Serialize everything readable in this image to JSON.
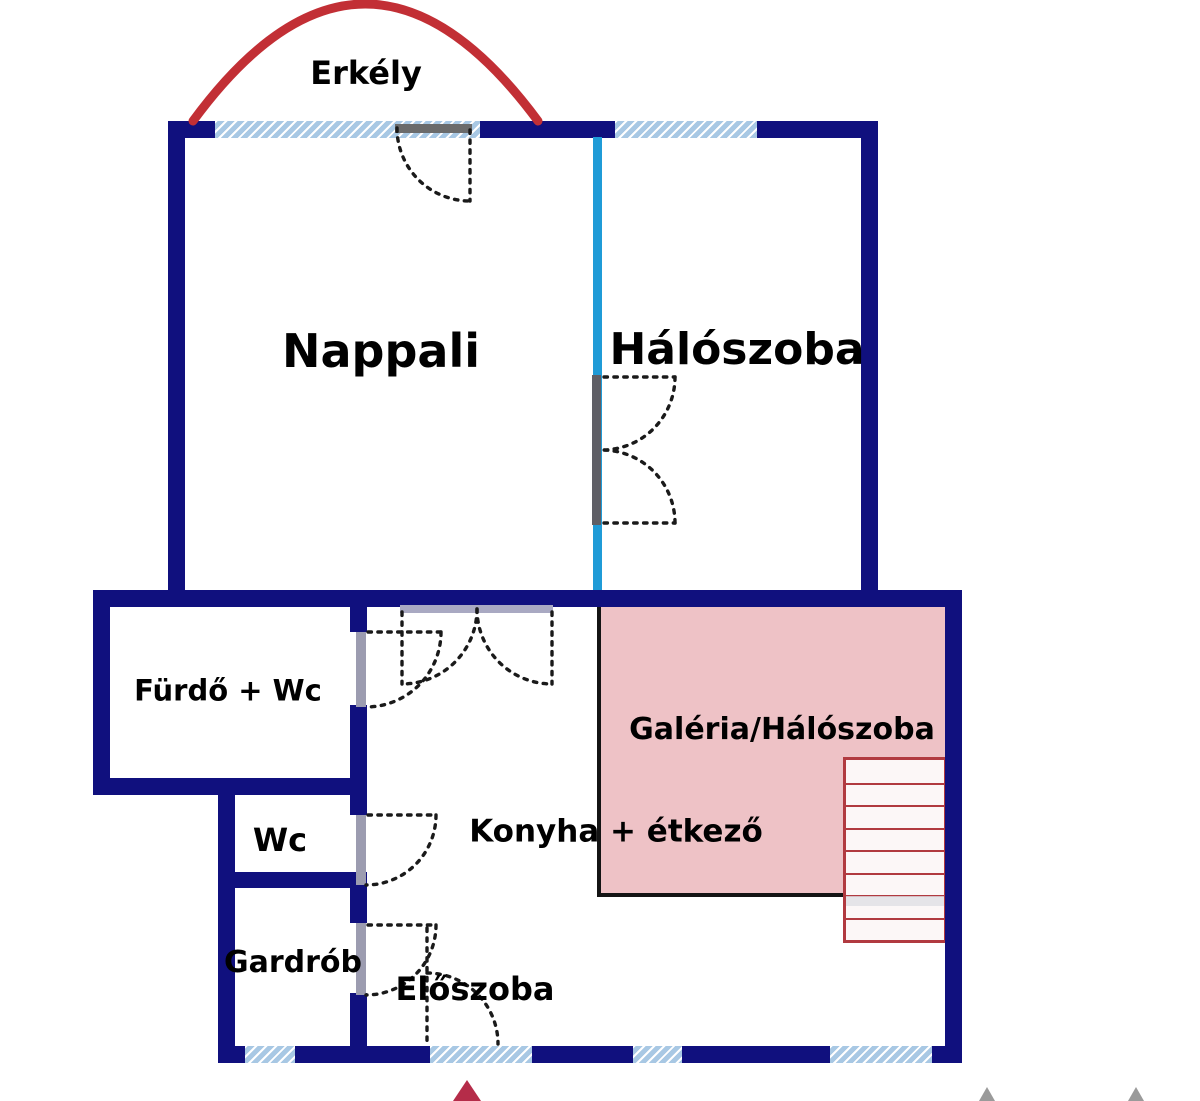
{
  "colors": {
    "wall_navy": "#10107e",
    "partition_cyan": "#1f9bd7",
    "window_fill": "#a8c8e4",
    "window_stripe": "#ffffff",
    "balcony_red": "#c22f35",
    "gallery_pink": "#eec2c6",
    "gallery_border": "#141414",
    "stair_red": "#b13a40",
    "stair_fill": "#fcf7f7",
    "stair_band": "#dfdfe4",
    "door_dot": "#1a1a1a",
    "arrow_red": "#b52c49",
    "arrow_gray": "#9a9a9a",
    "text": "#000000"
  },
  "labels": [
    {
      "id": "erkely",
      "text": "Erkély",
      "x": 366,
      "y": 73,
      "size": 32
    },
    {
      "id": "nappali",
      "text": "Nappali",
      "x": 381,
      "y": 351,
      "size": 46
    },
    {
      "id": "haloszoba",
      "text": "Hálószoba",
      "x": 737,
      "y": 350,
      "size": 44
    },
    {
      "id": "furdo",
      "text": "Fürdő + Wc",
      "x": 228,
      "y": 691,
      "size": 29
    },
    {
      "id": "wc",
      "text": "Wc",
      "x": 280,
      "y": 840,
      "size": 32
    },
    {
      "id": "gardrob",
      "text": "Gardrób",
      "x": 293,
      "y": 963,
      "size": 30
    },
    {
      "id": "eloszoba",
      "text": "Előszoba",
      "x": 475,
      "y": 989,
      "size": 32
    },
    {
      "id": "konyha",
      "text": "Konyha + étkező",
      "x": 616,
      "y": 832,
      "size": 31
    },
    {
      "id": "galeria",
      "text": "Galéria/Hálószoba",
      "x": 782,
      "y": 730,
      "size": 30
    }
  ],
  "walls": [
    {
      "name": "top-wall",
      "x": 168,
      "y": 121,
      "w": 710,
      "h": 17
    },
    {
      "name": "nappali-left-wall",
      "x": 168,
      "y": 121,
      "w": 17,
      "h": 469
    },
    {
      "name": "haloszoba-right-wall",
      "x": 861,
      "y": 121,
      "w": 17,
      "h": 469
    },
    {
      "name": "floor-divider-wall",
      "x": 93,
      "y": 590,
      "w": 869,
      "h": 17
    },
    {
      "name": "bath-left-wall",
      "x": 93,
      "y": 590,
      "w": 17,
      "h": 202
    },
    {
      "name": "bath-bottom-wall",
      "x": 93,
      "y": 778,
      "w": 274,
      "h": 17
    },
    {
      "name": "stack-left-wall",
      "x": 218,
      "y": 778,
      "w": 17,
      "h": 285
    },
    {
      "name": "wc-bottom-wall",
      "x": 218,
      "y": 872,
      "w": 149,
      "h": 16
    },
    {
      "name": "stack-right-wall-a",
      "x": 350,
      "y": 590,
      "w": 17,
      "h": 42
    },
    {
      "name": "stack-right-wall-b",
      "x": 350,
      "y": 705,
      "w": 17,
      "h": 110
    },
    {
      "name": "stack-right-wall-c",
      "x": 350,
      "y": 885,
      "w": 17,
      "h": 38
    },
    {
      "name": "stack-right-wall-d",
      "x": 350,
      "y": 993,
      "w": 17,
      "h": 53
    },
    {
      "name": "bottom-wall",
      "x": 218,
      "y": 1046,
      "w": 744,
      "h": 17
    },
    {
      "name": "lower-right-wall",
      "x": 945,
      "y": 590,
      "w": 17,
      "h": 473
    }
  ],
  "windows": [
    {
      "name": "nappali-window",
      "x": 215,
      "y": 121,
      "w": 265,
      "h": 17
    },
    {
      "name": "haloszoba-window",
      "x": 615,
      "y": 121,
      "w": 142,
      "h": 17
    },
    {
      "name": "gardrob-vent-window",
      "x": 245,
      "y": 1046,
      "w": 50,
      "h": 17
    },
    {
      "name": "entry-window",
      "x": 430,
      "y": 1046,
      "w": 102,
      "h": 17
    },
    {
      "name": "hall-window",
      "x": 633,
      "y": 1046,
      "w": 49,
      "h": 17
    },
    {
      "name": "gallery-window",
      "x": 830,
      "y": 1046,
      "w": 102,
      "h": 17
    }
  ],
  "partition": {
    "name": "nappali-haloszoba-partition",
    "x": 593,
    "y": 137,
    "w": 9,
    "h": 453
  },
  "jambs": [
    {
      "name": "balcony-door-header",
      "x": 395,
      "y": 124,
      "w": 77,
      "h": 9,
      "color": "#6b6b6b"
    },
    {
      "name": "living-kitchen-door-header",
      "x": 400,
      "y": 605,
      "w": 153,
      "h": 8,
      "color": "#a9a9c2"
    },
    {
      "name": "bedroom-door-jamb",
      "x": 592,
      "y": 375,
      "w": 9,
      "h": 150,
      "color": "#5f5f66"
    },
    {
      "name": "bath-door-jamb",
      "x": 356,
      "y": 632,
      "w": 10,
      "h": 75,
      "color": "#9c9cb0"
    },
    {
      "name": "wc-door-jamb",
      "x": 356,
      "y": 815,
      "w": 10,
      "h": 70,
      "color": "#9c9cb0"
    },
    {
      "name": "gardrob-door-jamb",
      "x": 356,
      "y": 923,
      "w": 10,
      "h": 72,
      "color": "#9c9cb0"
    }
  ],
  "gallery": {
    "name": "gallery-area",
    "x": 597,
    "y": 607,
    "w": 348,
    "h": 290
  },
  "stairs": {
    "name": "stairs",
    "x": 843,
    "y": 757,
    "w": 104,
    "h": 186,
    "treads": 8,
    "band_y": 893,
    "band_h": 10
  },
  "balcony": {
    "arc_path": "M193 121 Q365 -113 538 121"
  },
  "doors": [
    {
      "name": "balcony-door",
      "paths": [
        "M397 128 A73 73 0 0 0 470 201",
        "M470 130 L470 201"
      ]
    },
    {
      "name": "living-kitchen-double-door",
      "paths": [
        "M477 609 A75 75 0 0 1 402 684",
        "M477 609 A75 75 0 0 0 552 684",
        "M402 612 L402 684",
        "M552 612 L552 684"
      ]
    },
    {
      "name": "bedroom-double-door",
      "paths": [
        "M675 377 A73 73 0 0 1 602 450",
        "M675 523 A73 73 0 0 0 602 450",
        "M604 377 L675 377",
        "M604 523 L675 523"
      ]
    },
    {
      "name": "bath-door",
      "paths": [
        "M441 632 A75 75 0 0 1 366 707",
        "M368 632 L441 632"
      ]
    },
    {
      "name": "wc-door",
      "paths": [
        "M436 815 A70 70 0 0 1 366 885",
        "M368 815 L436 815"
      ]
    },
    {
      "name": "gardrob-door",
      "paths": [
        "M436 925 A70 70 0 0 1 366 995",
        "M368 925 L436 925"
      ]
    },
    {
      "name": "entry-door",
      "paths": [
        "M427 973 A71 71 0 0 1 498 1044",
        "M427 928 L427 1044"
      ]
    }
  ],
  "arrows": [
    {
      "name": "north-arrow",
      "points": "467,1080 453,1101 481,1101",
      "color": "#b52c49"
    },
    {
      "name": "scale-arrow-left",
      "points": "987,1087 979,1101 995,1101",
      "color": "#9a9a9a"
    },
    {
      "name": "scale-arrow-right",
      "points": "1136,1087 1128,1101 1144,1101",
      "color": "#9a9a9a"
    }
  ]
}
